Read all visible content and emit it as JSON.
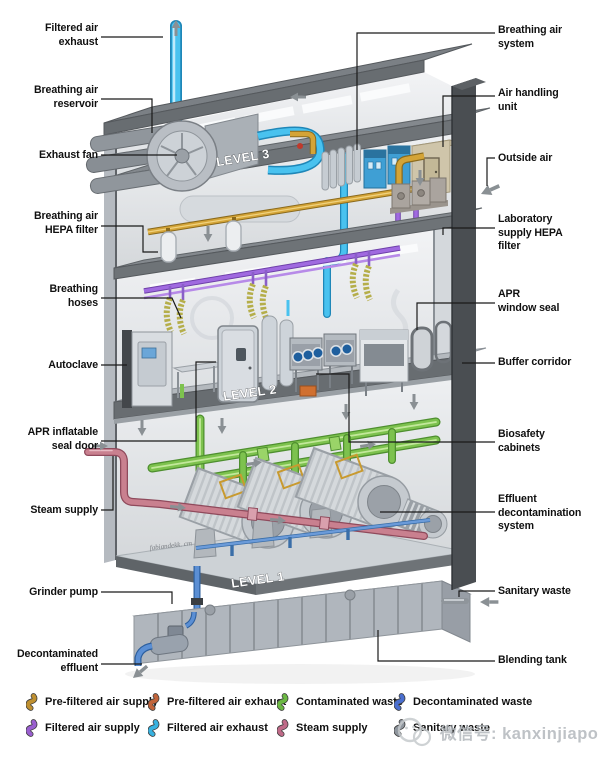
{
  "figure": {
    "type": "isometric cutaway diagram",
    "subject": "Biosafety laboratory building mechanical systems"
  },
  "levels": [
    {
      "label": "LEVEL 3"
    },
    {
      "label": "LEVEL 2"
    },
    {
      "label": "LEVEL 1"
    }
  ],
  "labels": {
    "left": [
      {
        "text": "Filtered air\nexhaust"
      },
      {
        "text": "Breathing air\nreservoir"
      },
      {
        "text": "Exhaust fan"
      },
      {
        "text": "Breathing air\nHEPA filter"
      },
      {
        "text": "Breathing\nhoses"
      },
      {
        "text": "Autoclave"
      },
      {
        "text": "APR inflatable\nseal door"
      },
      {
        "text": "Steam supply"
      },
      {
        "text": "Grinder pump"
      },
      {
        "text": "Decontaminated\neffluent"
      }
    ],
    "right": [
      {
        "text": "Breathing air\nsystem"
      },
      {
        "text": "Air handling\nunit"
      },
      {
        "text": "Outside air"
      },
      {
        "text": "Laboratory\nsupply HEPA\nfilter"
      },
      {
        "text": "APR\nwindow seal"
      },
      {
        "text": "Buffer corridor"
      },
      {
        "text": "Biosafety\ncabinets"
      },
      {
        "text": "Effluent\ndecontamination\nsystem"
      },
      {
        "text": "Sanitary waste"
      },
      {
        "text": "Blending tank"
      }
    ]
  },
  "legend": {
    "items": [
      {
        "label": "Pre-filtered air supply",
        "color": "#bf9030"
      },
      {
        "label": "Filtered air supply",
        "color": "#9a5fd0"
      },
      {
        "label": "Pre-filtered air exhaust",
        "color": "#c2643a"
      },
      {
        "label": "Filtered air exhaust",
        "color": "#38b2e0"
      },
      {
        "label": "Contaminated waste",
        "color": "#6cb944"
      },
      {
        "label": "Steam supply",
        "color": "#c06a88"
      },
      {
        "label": "Decontaminated waste",
        "color": "#4a6fd0"
      },
      {
        "label": "Sanitary waste",
        "color": "#8f969e"
      }
    ]
  },
  "watermark": {
    "text": "微信号: kanxinjiapo"
  },
  "signature": {
    "text": "fabiandekk. cm"
  }
}
